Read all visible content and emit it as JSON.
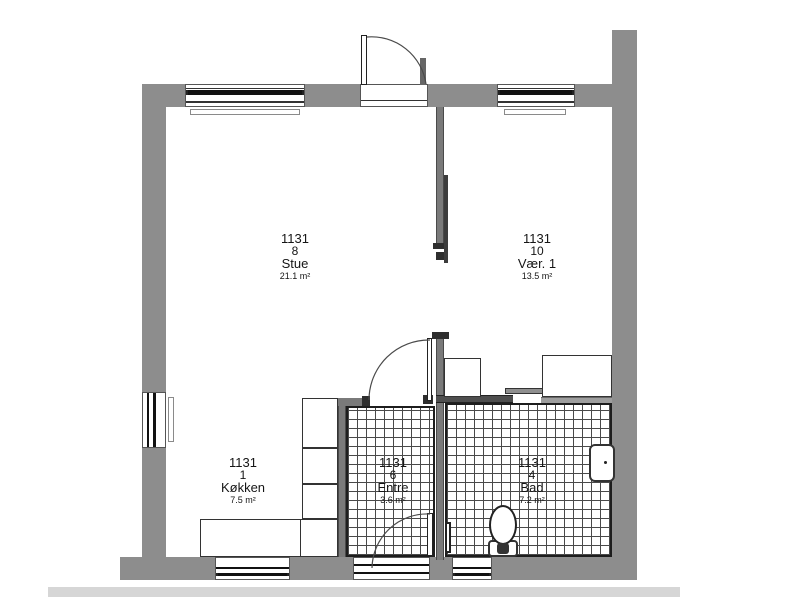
{
  "drawing": {
    "kind": "apartment floor plan",
    "unit_id": "1131"
  },
  "colors": {
    "wall_gray": "#8d8d8d",
    "interior_wall_gray": "#7a7a7a",
    "wall_cap_dark": "#2e2e2e",
    "tile_line": "#4a4a4a",
    "fixture_line": "#222222",
    "ground_strip": "#d6d6d6",
    "background": "#ffffff"
  },
  "rooms": [
    {
      "id": "stue",
      "unit": "1131",
      "number": "8",
      "name": "Stue",
      "area": "21.1 m²"
    },
    {
      "id": "vaer1",
      "unit": "1131",
      "number": "10",
      "name": "Vær. 1",
      "area": "13.5 m²"
    },
    {
      "id": "kokken",
      "unit": "1131",
      "number": "1",
      "name": "Køkken",
      "area": "7.5 m²"
    },
    {
      "id": "entre",
      "unit": "1131",
      "number": "6",
      "name": "Entre",
      "area": "3.6 m²"
    },
    {
      "id": "bad",
      "unit": "1131",
      "number": "4",
      "name": "Bad",
      "area": "7.2 m²"
    }
  ]
}
